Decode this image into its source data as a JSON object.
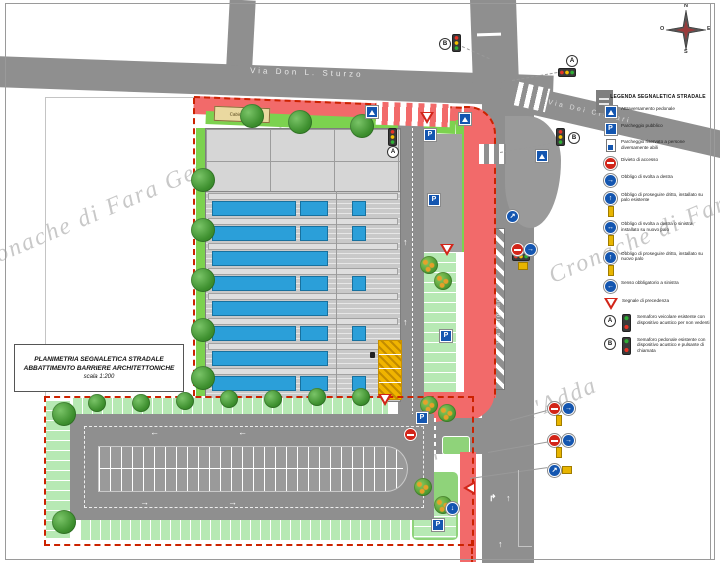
{
  "drawing": {
    "watermark": "Cronache di Fara Gera d'Adda",
    "streets": {
      "top": "Via Don L. Sturzo",
      "diagonal": "Via Dei Credari",
      "vertical": "Via Bergamo"
    },
    "cabina_label": "Cabina Enel",
    "title_block": {
      "line1": "PLANIMETRIA SEGNALETICA STRADALE",
      "line2": "ABBATTIMENTO BARRIERE ARCHITETTONICHE",
      "line3": "scala 1:200"
    },
    "compass": {
      "n": "N",
      "e": "E",
      "s": "S",
      "o": "O"
    },
    "callout_a": "A",
    "callout_b": "B",
    "legend": {
      "title": "LEGENDA SEGNALETICA STRADALE",
      "items": [
        {
          "icon": "sign-crossing",
          "label": "Attraversamento pedonale"
        },
        {
          "icon": "sign-parking",
          "label": "Parcheggio pubblico"
        },
        {
          "icon": "sign-disabled",
          "label": "Parcheggio riservato a persone diversamente abili"
        },
        {
          "icon": "sign-no-entry",
          "label": "Divieto di accesso"
        },
        {
          "icon": "sign-right",
          "label": "Obbligo di svolta a destra"
        },
        {
          "icon": "sign-straight-post",
          "label": "Obbligo di proseguire dritto, installato su palo esistente"
        },
        {
          "icon": "sign-right-left-post",
          "label": "Obbligo di svolta a destra o sinistra, installato su nuovo palo"
        },
        {
          "icon": "sign-straight-post2",
          "label": "Obbligo di proseguire dritto, installato su nuovo palo"
        },
        {
          "icon": "sign-left",
          "label": "Senso obbligatorio a sinistra"
        },
        {
          "icon": "sign-giveway",
          "label": "Segnale di precedenza"
        },
        {
          "icon": "tl-a",
          "tag": "A",
          "label": "Semaforo veicolare esistente con dispositivo acustico per non vedenti"
        },
        {
          "icon": "tl-b",
          "tag": "B",
          "label": "Semaforo pedonale esistente con dispositivo acustico e pulsante di chiamata"
        }
      ]
    },
    "colors": {
      "road": "#8f8f8f",
      "site_boundary": "#cc2200",
      "pedestrian_path": "#f26a6a",
      "green": "#7cd24f",
      "stall_green": "#b7e9b4",
      "roof_blue": "#2b9fd9",
      "disabled_yellow": "#f0b400",
      "sign_blue": "#1456b0",
      "sign_red": "#d22519"
    }
  }
}
